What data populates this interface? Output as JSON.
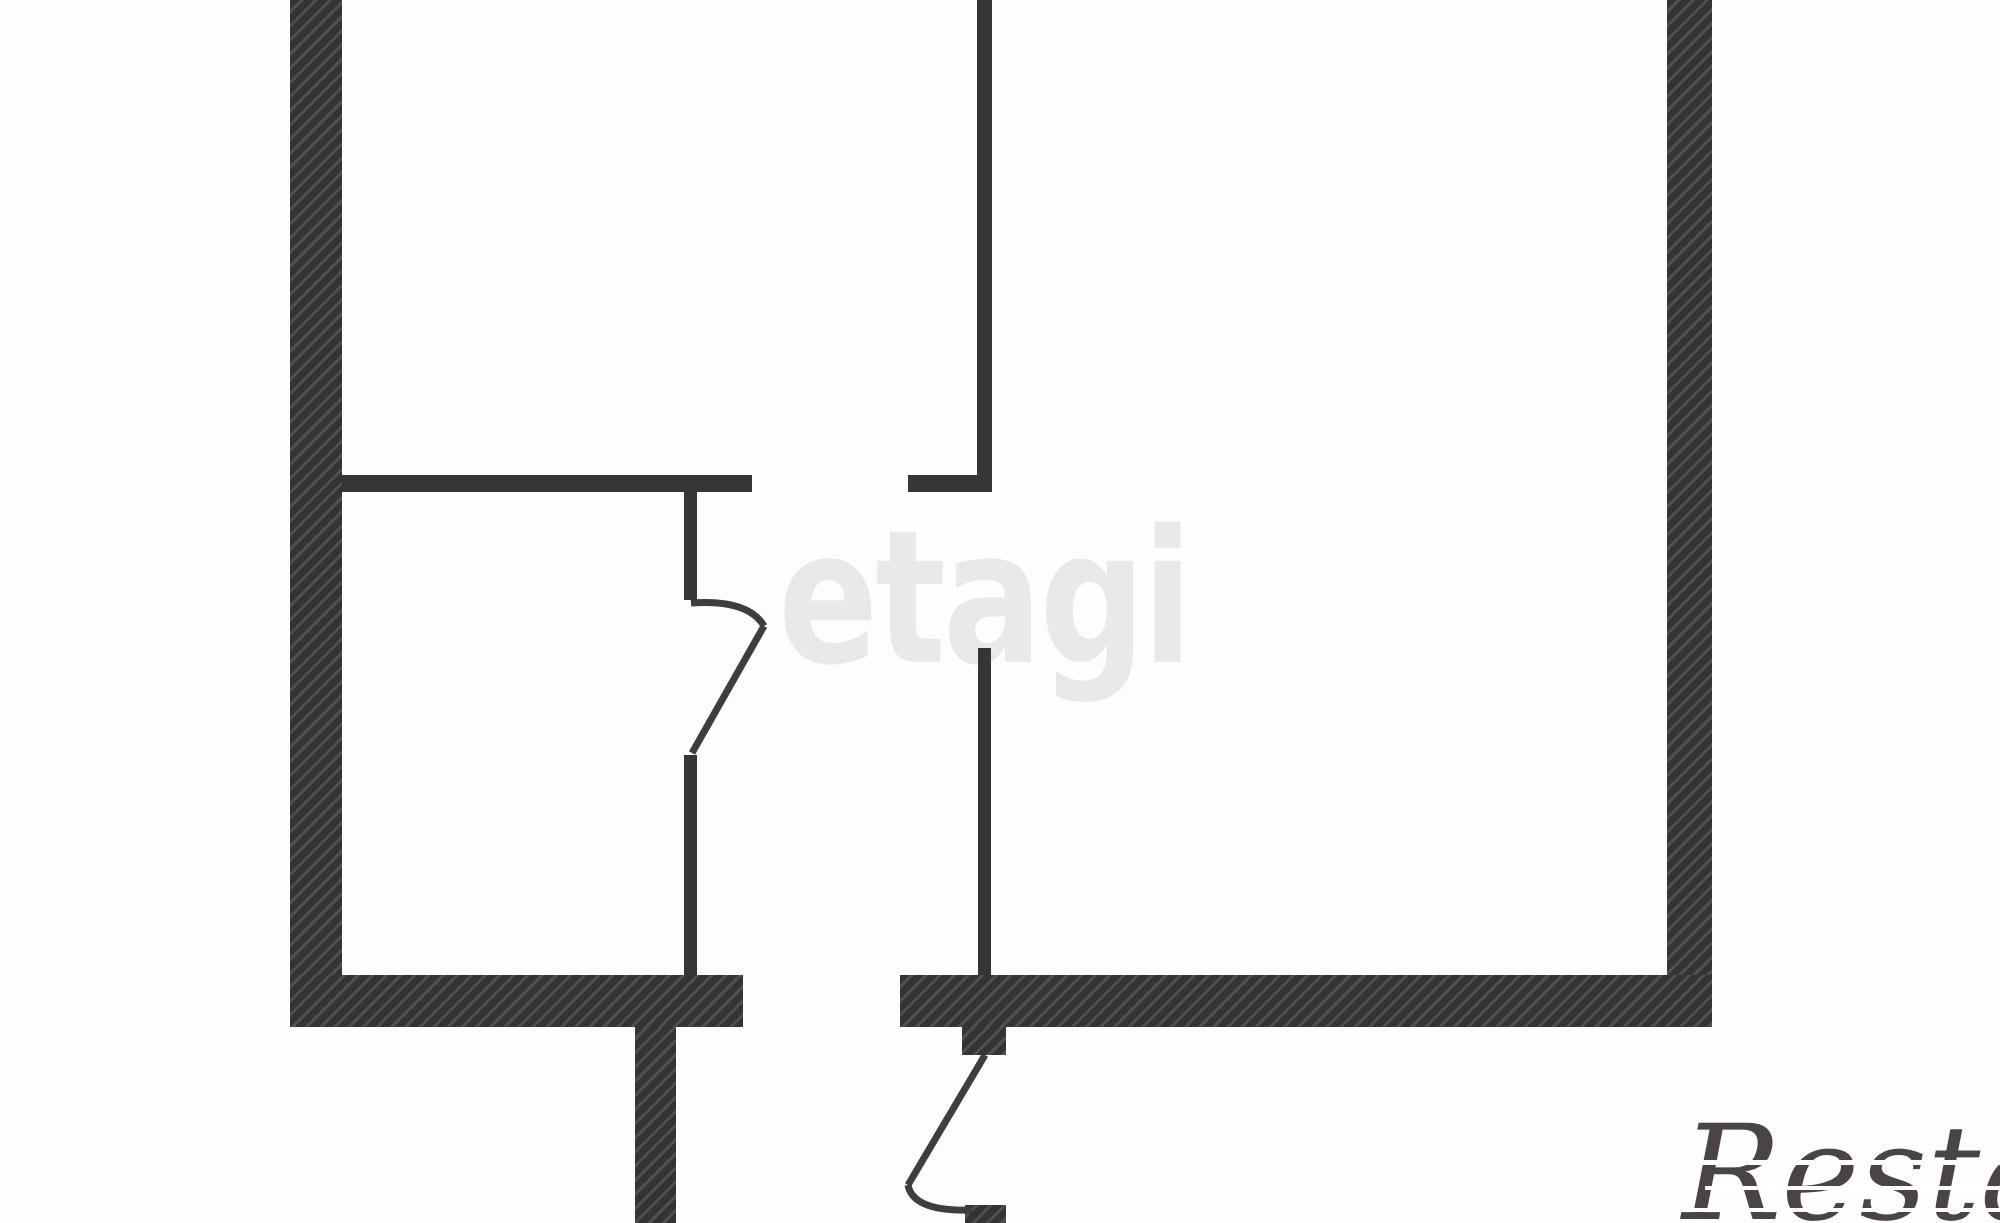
{
  "plan": {
    "canvas": {
      "width": 2000,
      "height": 1223
    },
    "colors": {
      "background": "#fdfdfd",
      "wall_fill_dark": "#343434",
      "wall_hatch_light": "#4f4f4f",
      "thin_wall": "#363636",
      "door_line": "#3e3e3e"
    },
    "stroke_width": 7,
    "thick_walls": [
      {
        "name": "left-exterior-wall",
        "x": 290,
        "y": 0,
        "w": 52,
        "h": 1027
      },
      {
        "name": "right-exterior-wall",
        "x": 1667,
        "y": 0,
        "w": 45,
        "h": 1027
      },
      {
        "name": "bottom-wall-left-segment",
        "x": 290,
        "y": 975,
        "w": 453,
        "h": 52
      },
      {
        "name": "bottom-wall-right-segment",
        "x": 900,
        "y": 975,
        "w": 812,
        "h": 52
      },
      {
        "name": "lower-left-wall-stub",
        "x": 635,
        "y": 1027,
        "w": 41,
        "h": 196
      },
      {
        "name": "entry-door-hinge-stub",
        "x": 962,
        "y": 1027,
        "w": 44,
        "h": 28
      },
      {
        "name": "entry-door-latch-stub",
        "x": 965,
        "y": 1205,
        "w": 41,
        "h": 18
      }
    ],
    "thin_walls": [
      {
        "name": "top-middle-partition",
        "x": 977,
        "y": 0,
        "w": 15,
        "h": 492
      },
      {
        "name": "upper-horizontal-partition-left",
        "x": 342,
        "y": 475,
        "w": 410,
        "h": 17
      },
      {
        "name": "upper-horizontal-partition-right",
        "x": 908,
        "y": 475,
        "w": 84,
        "h": 17
      },
      {
        "name": "left-door-jamb-upper",
        "x": 684,
        "y": 492,
        "w": 13,
        "h": 108
      },
      {
        "name": "left-door-jamb-lower",
        "x": 684,
        "y": 755,
        "w": 13,
        "h": 220
      },
      {
        "name": "middle-vertical-partition",
        "x": 978,
        "y": 648,
        "w": 13,
        "h": 327
      }
    ],
    "door_strokes": [
      {
        "name": "interior-door-swing-arc",
        "path": "M 691 603 Q 748 599 764 626"
      },
      {
        "name": "interior-door-leaf",
        "path": "M 764 626 L 692 753"
      },
      {
        "name": "entry-door-leaf",
        "path": "M 985 1055 L 908 1185"
      },
      {
        "name": "entry-door-swing-arc",
        "path": "M 908 1185 Q 913 1212 972 1210"
      }
    ]
  },
  "watermarks": {
    "center": {
      "text": "etagi",
      "color": "#e9e9e9"
    },
    "corner": {
      "text": "Restate",
      "color": "#4a4449"
    }
  }
}
